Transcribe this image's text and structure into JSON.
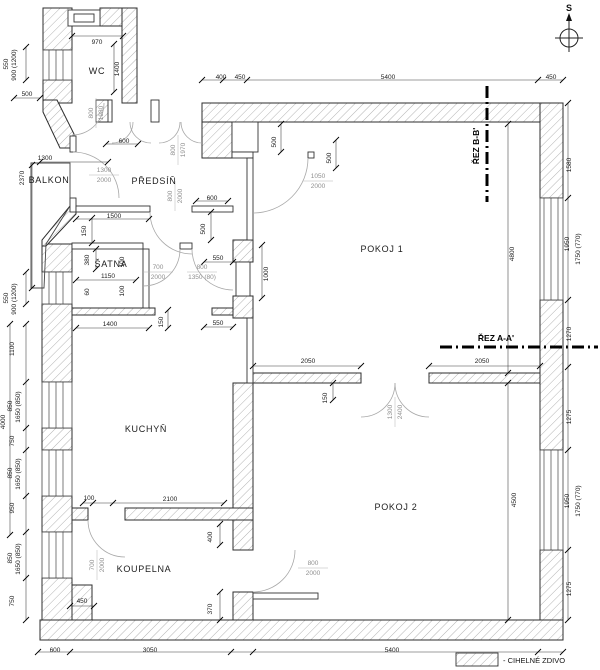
{
  "compass": {
    "label": "S"
  },
  "legend": {
    "label": "- CIHELNÉ ZDIVO"
  },
  "sections": [
    {
      "id": "rez-bb",
      "label": "ŘEZ B-B'"
    },
    {
      "id": "rez-aa",
      "label": "ŘEZ A-A'"
    }
  ],
  "rooms": [
    {
      "id": "wc",
      "label": "WC",
      "x": 97,
      "y": 71
    },
    {
      "id": "balkon",
      "label": "BALKON",
      "x": 49,
      "y": 180
    },
    {
      "id": "predsin",
      "label": "PŘEDSÍŇ",
      "x": 154,
      "y": 181
    },
    {
      "id": "satna",
      "label": "ŠATNA",
      "x": 111,
      "y": 264
    },
    {
      "id": "kuchyn",
      "label": "KUCHYŇ",
      "x": 146,
      "y": 429
    },
    {
      "id": "koupelna",
      "label": "KOUPELNA",
      "x": 144,
      "y": 569
    },
    {
      "id": "pokoj1",
      "label": "POKOJ 1",
      "x": 382,
      "y": 249
    },
    {
      "id": "pokoj2",
      "label": "POKOJ 2",
      "x": 396,
      "y": 507
    }
  ],
  "openings": [
    {
      "top": "1300",
      "bottom": "2000",
      "x": 104,
      "y": 174
    },
    {
      "top": "800",
      "bottom": "1980",
      "x": 95,
      "y": 113,
      "r": 1
    },
    {
      "top": "800",
      "bottom": "1970",
      "x": 177,
      "y": 150,
      "r": 1
    },
    {
      "top": "800",
      "bottom": "2000",
      "x": 174,
      "y": 196,
      "r": 1
    },
    {
      "top": "1050",
      "bottom": "2000",
      "x": 318,
      "y": 180
    },
    {
      "top": "700",
      "bottom": "2000",
      "x": 158,
      "y": 271
    },
    {
      "top": "800",
      "bottom": "1350 (80)",
      "x": 202,
      "y": 271
    },
    {
      "top": "1300",
      "bottom": "2400",
      "x": 394,
      "y": 412,
      "r": 1
    },
    {
      "top": "800",
      "bottom": "2000",
      "x": 313,
      "y": 567
    },
    {
      "top": "700",
      "bottom": "2000",
      "x": 96,
      "y": 565,
      "r": 1
    }
  ],
  "dimensions": [
    {
      "t": "400",
      "x": 221,
      "y": 77
    },
    {
      "t": "450",
      "x": 240,
      "y": 77
    },
    {
      "t": "5400",
      "x": 388,
      "y": 77
    },
    {
      "t": "450",
      "x": 551,
      "y": 77
    },
    {
      "t": "550",
      "x": 8,
      "y": 62,
      "r": 1
    },
    {
      "t": "900 (1200)",
      "x": 16,
      "y": 63,
      "r": 1
    },
    {
      "t": "500",
      "x": 27,
      "y": 94
    },
    {
      "t": "970",
      "x": 97,
      "y": 42
    },
    {
      "t": "1400",
      "x": 119,
      "y": 67,
      "r": 1
    },
    {
      "t": "1300",
      "x": 45,
      "y": 158
    },
    {
      "t": "2370",
      "x": 24,
      "y": 176,
      "r": 1
    },
    {
      "t": "600",
      "x": 124,
      "y": 141
    },
    {
      "t": "600",
      "x": 212,
      "y": 198
    },
    {
      "t": "500",
      "x": 205,
      "y": 227,
      "r": 1
    },
    {
      "t": "1500",
      "x": 114,
      "y": 216
    },
    {
      "t": "150",
      "x": 86,
      "y": 229,
      "r": 1
    },
    {
      "t": "380",
      "x": 89,
      "y": 258,
      "r": 1
    },
    {
      "t": "100",
      "x": 124,
      "y": 260,
      "r": 1
    },
    {
      "t": "550",
      "x": 218,
      "y": 258
    },
    {
      "t": "1150",
      "x": 108,
      "y": 276
    },
    {
      "t": "60",
      "x": 89,
      "y": 290,
      "r": 1
    },
    {
      "t": "100",
      "x": 124,
      "y": 289,
      "r": 1
    },
    {
      "t": "1400",
      "x": 110,
      "y": 324
    },
    {
      "t": "150",
      "x": 163,
      "y": 320,
      "r": 1
    },
    {
      "t": "550",
      "x": 218,
      "y": 323
    },
    {
      "t": "550",
      "x": 8,
      "y": 296,
      "r": 1
    },
    {
      "t": "900 (1200)",
      "x": 16,
      "y": 297,
      "r": 1
    },
    {
      "t": "1100",
      "x": 14,
      "y": 347,
      "r": 1
    },
    {
      "t": "4000",
      "x": 5,
      "y": 420,
      "r": 1
    },
    {
      "t": "850",
      "x": 12,
      "y": 404,
      "r": 1
    },
    {
      "t": "1650 (850)",
      "x": 20,
      "y": 405,
      "r": 1
    },
    {
      "t": "750",
      "x": 14,
      "y": 439,
      "r": 1
    },
    {
      "t": "850",
      "x": 12,
      "y": 471,
      "r": 1
    },
    {
      "t": "1650 (850)",
      "x": 20,
      "y": 472,
      "r": 1
    },
    {
      "t": "950",
      "x": 14,
      "y": 506,
      "r": 1
    },
    {
      "t": "850",
      "x": 12,
      "y": 556,
      "r": 1
    },
    {
      "t": "1650 (850)",
      "x": 20,
      "y": 557,
      "r": 1
    },
    {
      "t": "750",
      "x": 14,
      "y": 599,
      "r": 1
    },
    {
      "t": "100",
      "x": 89,
      "y": 498
    },
    {
      "t": "2100",
      "x": 170,
      "y": 499
    },
    {
      "t": "400",
      "x": 212,
      "y": 535,
      "r": 1
    },
    {
      "t": "450",
      "x": 82,
      "y": 601
    },
    {
      "t": "370",
      "x": 212,
      "y": 607,
      "r": 1
    },
    {
      "t": "600",
      "x": 55,
      "y": 650
    },
    {
      "t": "3050",
      "x": 150,
      "y": 650
    },
    {
      "t": "5400",
      "x": 392,
      "y": 650
    },
    {
      "t": "500",
      "x": 276,
      "y": 140,
      "r": 1
    },
    {
      "t": "500",
      "x": 331,
      "y": 156,
      "r": 1
    },
    {
      "t": "1000",
      "x": 268,
      "y": 272,
      "r": 1
    },
    {
      "t": "2050",
      "x": 308,
      "y": 361
    },
    {
      "t": "2050",
      "x": 482,
      "y": 361
    },
    {
      "t": "150",
      "x": 327,
      "y": 396,
      "r": 1
    },
    {
      "t": "4800",
      "x": 514,
      "y": 252,
      "r": 1
    },
    {
      "t": "4500",
      "x": 516,
      "y": 498,
      "r": 1
    },
    {
      "t": "1580",
      "x": 571,
      "y": 163,
      "r": 1
    },
    {
      "t": "1950",
      "x": 569,
      "y": 242,
      "r": 1
    },
    {
      "t": "1750 (770)",
      "x": 580,
      "y": 247,
      "r": 1
    },
    {
      "t": "1270",
      "x": 571,
      "y": 332,
      "r": 1
    },
    {
      "t": "1275",
      "x": 571,
      "y": 415,
      "r": 1
    },
    {
      "t": "1950",
      "x": 569,
      "y": 499,
      "r": 1
    },
    {
      "t": "1750 (770)",
      "x": 580,
      "y": 499,
      "r": 1
    },
    {
      "t": "1275",
      "x": 571,
      "y": 587,
      "r": 1
    }
  ]
}
